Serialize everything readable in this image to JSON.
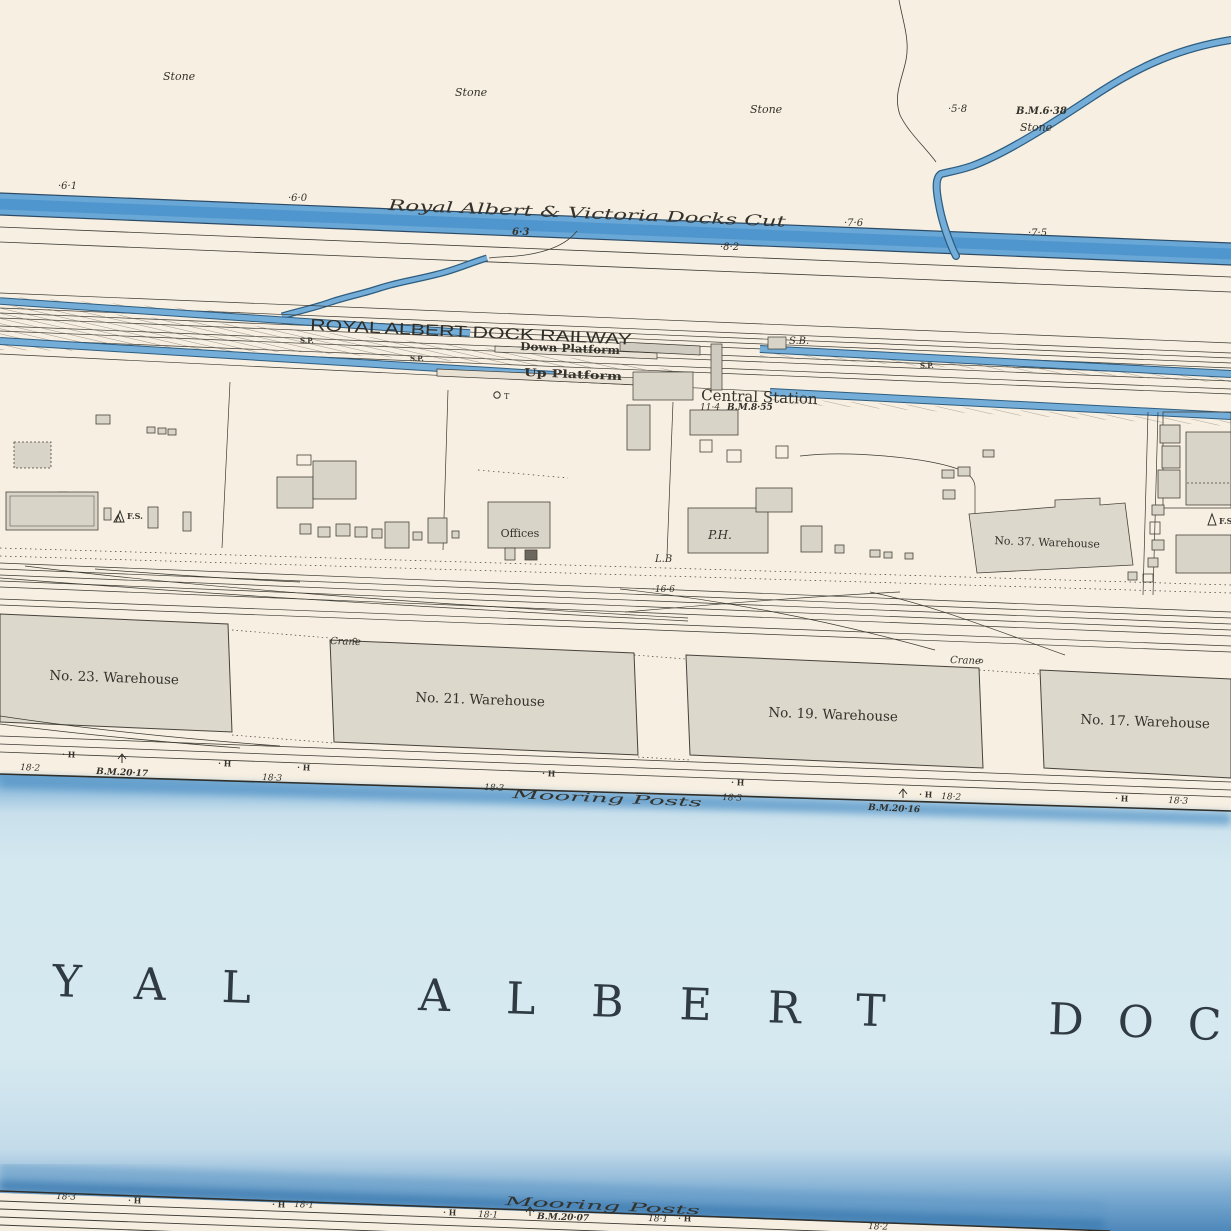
{
  "title_overlay": "Detail View",
  "colors": {
    "paper": "#f7efe1",
    "canal_blue": "#69a8d6",
    "dock_water_light": "#d4e8f0",
    "dock_water_edge": "#4a86ba",
    "building_gray": "#d8d4c8",
    "ink": "#3a3832"
  },
  "labels": {
    "stone": "Stone",
    "canal_name": "Royal  Albert  &  Victoria  Docks  Cut",
    "railway_name": "ROYAL ALBERT DOCK RAILWAY",
    "down_platform": "Down Platform",
    "up_platform": "Up Platform",
    "central_station": "Central Station",
    "signal_box": "S.B.",
    "signal_post": "S.P.",
    "flag_staff": "F.S.",
    "letter_box": "L.B",
    "public_house": "P.H.",
    "offices": "Offices",
    "telephone": "T",
    "crane": "Crane",
    "mooring_posts": "Mooring    Posts",
    "warehouse_37": "No. 37. Warehouse",
    "warehouse_23": "No. 23. Warehouse",
    "warehouse_21": "No. 21. Warehouse",
    "warehouse_19": "No. 19. Warehouse",
    "warehouse_17": "No. 17. Warehouse",
    "dock_name_p1": "YAL",
    "dock_name_p2": "ALBERT",
    "dock_name_p3": "DOC",
    "h_marker": "· H"
  },
  "benchmarks": {
    "bm_638": "B.M.6·38",
    "bm_855": "B.M.8·55",
    "bm_2017": "B.M.20·17",
    "bm_2016": "B.M.20·16",
    "bm_2007": "B.M.20·07"
  },
  "spot_heights": {
    "s58": "·5·8",
    "s61": "·6·1",
    "s60": "·6·0",
    "s63": "6·3",
    "s82": "·8·2",
    "s76": "·7·6",
    "s75": "·7·5",
    "s114": "11·4",
    "s166": "·16·6",
    "s181": "18·1",
    "s182": "18·2",
    "s183": "18·3"
  }
}
